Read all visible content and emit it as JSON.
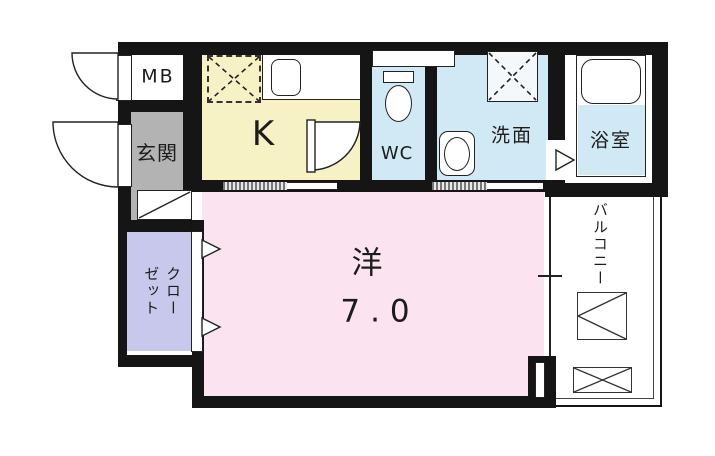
{
  "plan": {
    "rooms": {
      "mb": {
        "label": "MB"
      },
      "entrance": {
        "label": "玄関"
      },
      "kitchen": {
        "label": "K"
      },
      "wc": {
        "label": "WC"
      },
      "washroom": {
        "label": "洗面"
      },
      "bathroom": {
        "label": "浴室"
      },
      "closet": {
        "label": "クローゼット"
      },
      "balcony": {
        "label": "バルコニー"
      },
      "main_room": {
        "label": "洋",
        "size": "7.0"
      }
    },
    "colors": {
      "wall": "#151515",
      "kitchen": "#f7f2c6",
      "main_room": "#fbe4ef",
      "wet_area": "#d0e9f5",
      "closet": "#c8c8ec",
      "entrance": "#b3b3b3"
    }
  }
}
